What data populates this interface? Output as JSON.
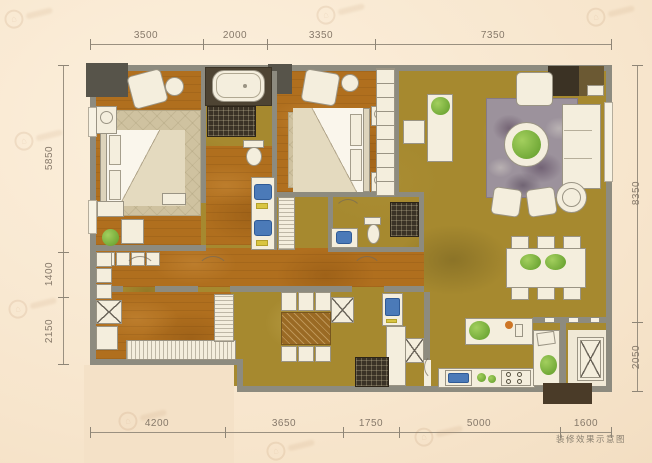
{
  "caption": "装修效果示意图",
  "dims": {
    "top": [
      "3500",
      "2000",
      "3350",
      "7350"
    ],
    "bottom": [
      "4200",
      "3650",
      "1750",
      "5000",
      "1600"
    ],
    "left": [
      "5850",
      "1400",
      "2150"
    ],
    "right": [
      "8350",
      "2050"
    ]
  },
  "colors": {
    "wood_floor": "#b06f1e",
    "stone_floor": "#a6892f",
    "wall_gray": "#8d8b7f",
    "fixture_blue": "#4b7ab8",
    "plant_green": "#6aa735",
    "dark_tile": "#4e4433",
    "paper_cream": "#f6e4cb"
  }
}
